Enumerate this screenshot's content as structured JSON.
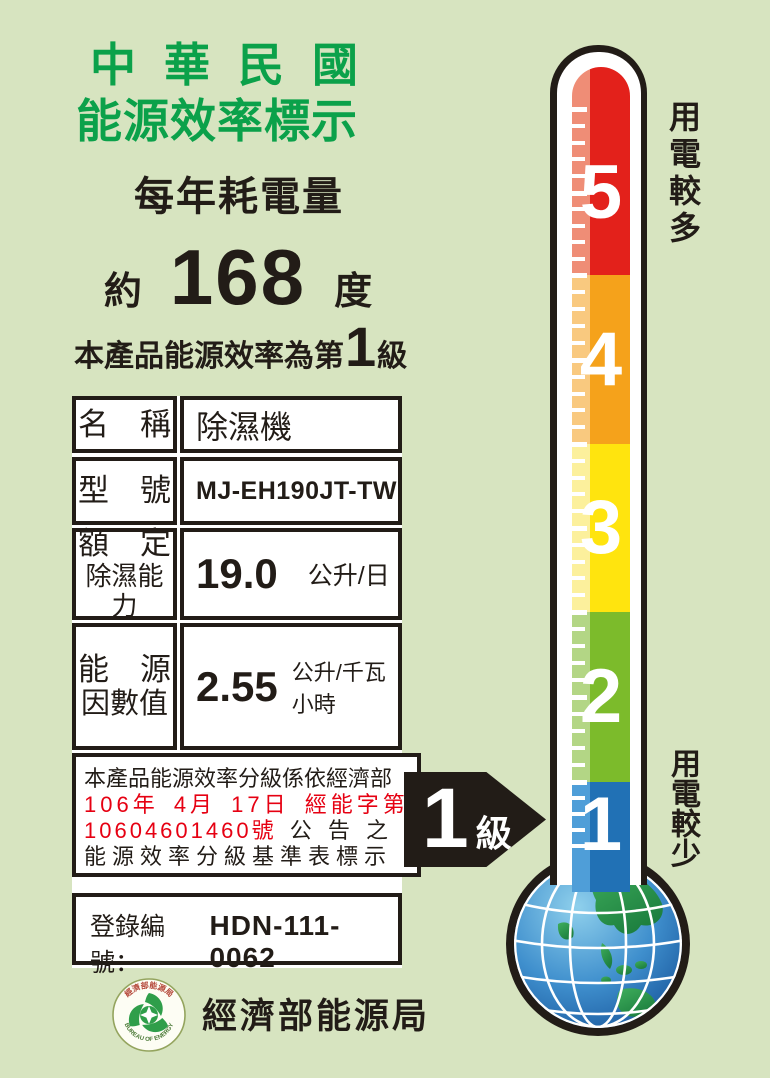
{
  "label": {
    "title_line1": "中華民國",
    "title_line2": "能源效率標示",
    "subtitle": "每年耗電量",
    "approx_prefix": "約",
    "annual_kwh": "168",
    "unit_degree": "度",
    "grade_prefix": "本產品能源效率為第",
    "grade_value": "1",
    "grade_suffix": "級"
  },
  "table": {
    "rows": [
      {
        "label": "名　稱",
        "value": "除濕機"
      },
      {
        "label": "型　號",
        "value": "MJ-EH190JT-TW"
      },
      {
        "label_line1": "額　定",
        "label_line2": "除濕能力",
        "value": "19.0",
        "unit": "公升/日"
      },
      {
        "label_line1": "能　源",
        "label_line2": "因數值",
        "value": "2.55",
        "unit": "公升/千瓦小時"
      }
    ],
    "note": {
      "line1": "本產品能源效率分級係依經濟部",
      "line2": "106年 4月 17日 經能字第",
      "line3_red": "10604601460號",
      "line3_black": "公 告 之",
      "line4": "能源效率分級基準表標示"
    },
    "registration_label": "登錄編號：",
    "registration_number": "HDN-111-0062"
  },
  "footer": {
    "agency": "經濟部能源局",
    "seal_top": "經濟部能源局",
    "seal_bottom": "BUREAU OF ENERGY"
  },
  "scale": {
    "top_label": "用電較多",
    "bottom_label": "用電較少",
    "selected_grade": "1",
    "levels": [
      {
        "grade": "5",
        "color": "#e3211b",
        "highlight": "#ef8d76"
      },
      {
        "grade": "4",
        "color": "#f5a21b",
        "highlight": "#f9c97f"
      },
      {
        "grade": "3",
        "color": "#ffe40e",
        "highlight": "#fcf09c"
      },
      {
        "grade": "2",
        "color": "#7cbb2b",
        "highlight": "#b3d685"
      },
      {
        "grade": "1",
        "color": "#2171b5",
        "highlight": "#4f9ed8"
      }
    ]
  },
  "arrow": {
    "grade": "1",
    "suffix": "級"
  },
  "colors": {
    "background": "#d7e4c0",
    "title_green": "#0ba14a",
    "text_black": "#221c17",
    "note_red": "#e60012",
    "cell_bg": "#ffffff",
    "thermo_outline": "#221c17"
  }
}
